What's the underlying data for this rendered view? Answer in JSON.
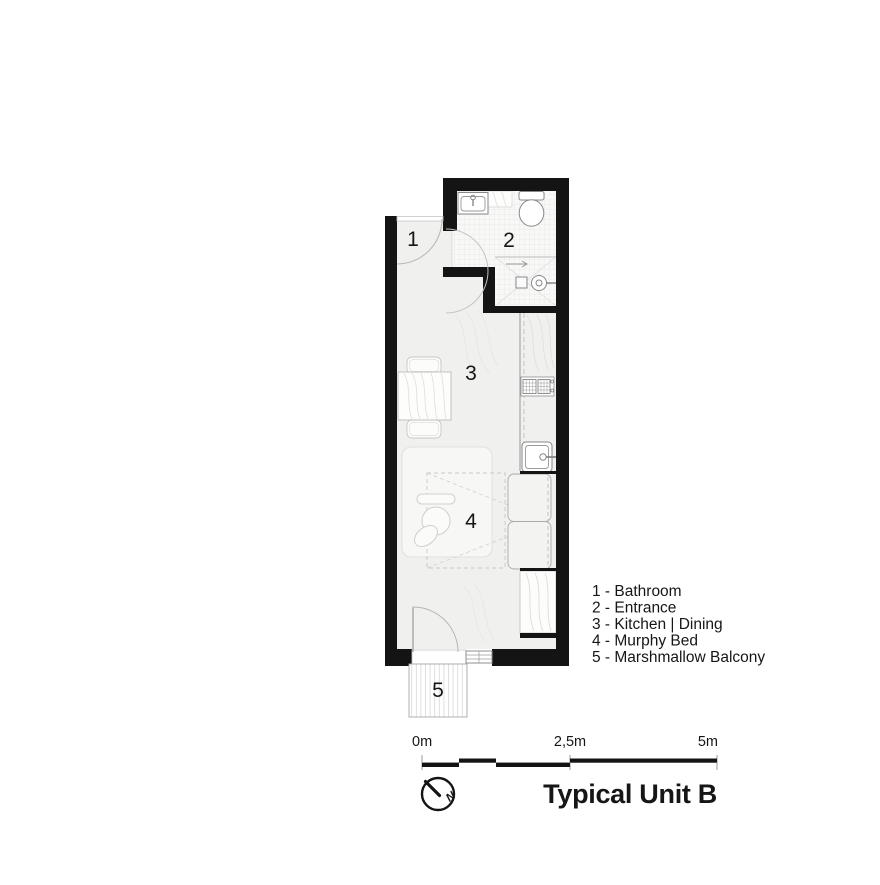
{
  "plan": {
    "name": "floor-plan",
    "room_numbers": [
      "1",
      "2",
      "3",
      "4",
      "5"
    ]
  },
  "legend": {
    "items": [
      "1 - Bathroom",
      "2 - Entrance",
      "3 - Kitchen | Dining",
      "4 - Murphy Bed",
      "5 - Marshmallow Balcony"
    ]
  },
  "scale_bar": {
    "start_label": "0m",
    "mid_label": "2,5m",
    "end_label": "5m"
  },
  "north_indicator": {
    "label": "N"
  },
  "title": "Typical Unit B",
  "colors": {
    "wall": "#141414",
    "floor": "#f0f0ef",
    "tile_line": "#e3e3e3",
    "fixture_line": "#888888"
  }
}
